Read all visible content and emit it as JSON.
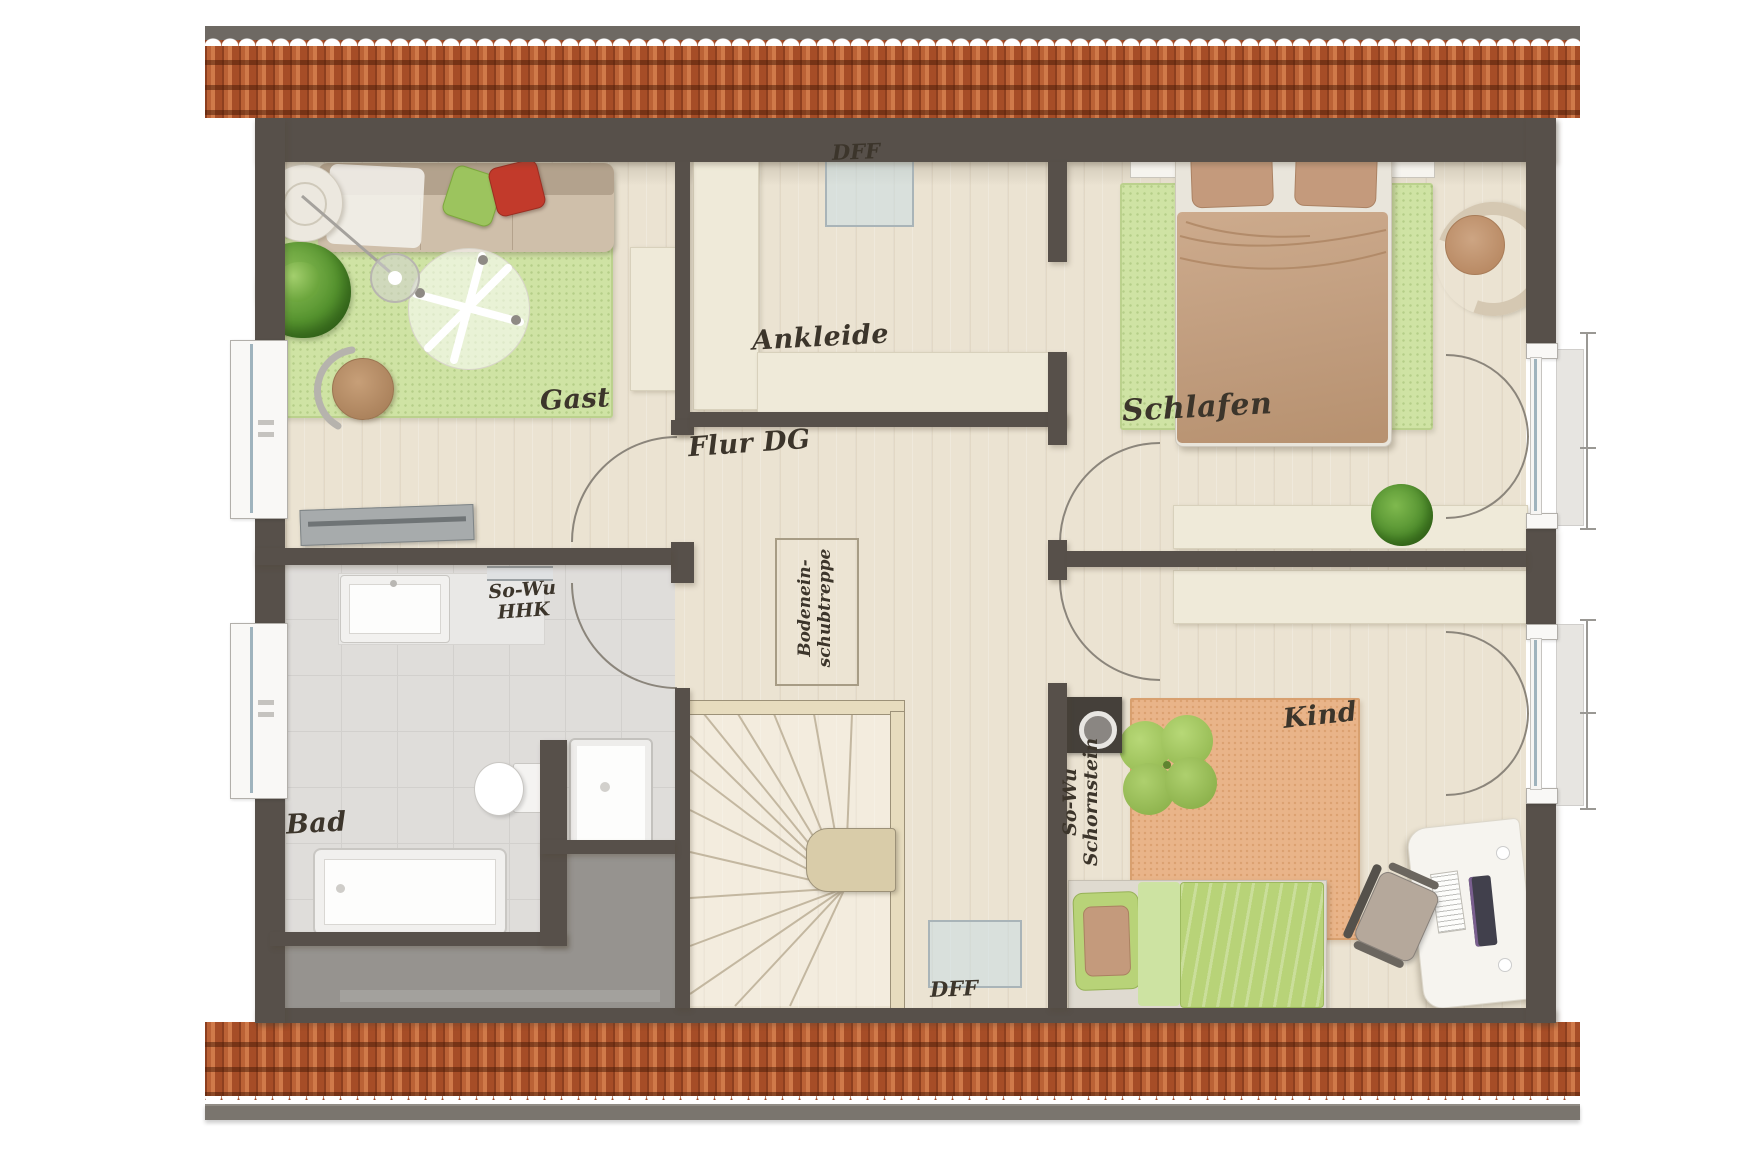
{
  "rooms": {
    "gast": "Gast",
    "ankleide": "Ankleide",
    "schlafen": "Schlafen",
    "flur": "Flur DG",
    "bad": "Bad",
    "kind": "Kind"
  },
  "annotations": {
    "dff_top": "DFF",
    "dff_bottom": "DFF",
    "so_wu": {
      "line1": "So-Wu",
      "line2": "HHK"
    },
    "schornstein": {
      "line1": "So-Wu",
      "line2": "Schornstein"
    },
    "attic_hatch": {
      "line1": "Bodenein-",
      "line2": "schubtreppe"
    }
  },
  "colors": {
    "wall": "#57504a",
    "roof_tile": "#b85f33",
    "roof_ridge": "#6e6963",
    "gutter": "#7a756e",
    "wood": "#ebe3d2",
    "tile_floor": "#dfddda",
    "tile_line": "#d2d0cd",
    "storage_gray": "#96938f",
    "rug_green": "#cfe3a4",
    "rug_orange": "#e9b489",
    "cream": "#efead9",
    "cream_border": "#d8d1bc",
    "sofa_body": "#cfbfaa",
    "sofa_back": "#b3a28d",
    "pillow_green": "#9cc45e",
    "pillow_red": "#c23a2b",
    "bed_duvet": "#c5a183",
    "duvet_green": "#b8d378",
    "pillow_brown": "#c49a7c",
    "label_ink": "#3c352b",
    "glass": "#9fb3bd",
    "arc_line": "#8b857b",
    "railing_wood": "#e7dcbe",
    "furniture_white": "#f6f4ef"
  }
}
